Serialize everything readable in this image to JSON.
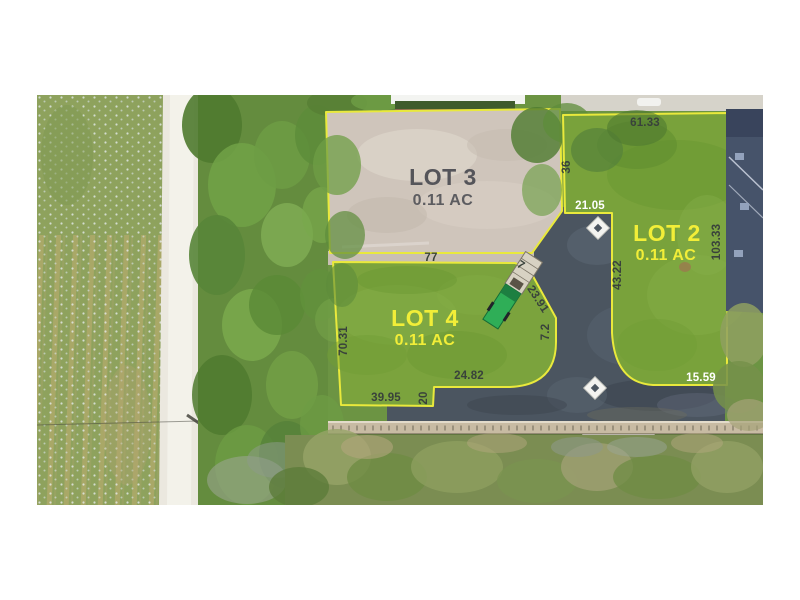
{
  "scene": {
    "type": "aerial-lot-survey-photo"
  },
  "lots": [
    {
      "name": "LOT 3",
      "area": "0.11 AC",
      "surface": "dirt",
      "label_color": "#55555a"
    },
    {
      "name": "LOT 2",
      "area": "0.11 AC",
      "surface": "grass",
      "label_color": "#f2ee38"
    },
    {
      "name": "LOT 4",
      "area": "0.11 AC",
      "surface": "grass",
      "label_color": "#f2ee38"
    }
  ],
  "dimensions": [
    {
      "value": "61.33",
      "lot": "LOT 2",
      "edge": "north",
      "text_color": "dark"
    },
    {
      "value": "36",
      "lot": "LOT 2",
      "edge": "west-upper",
      "text_color": "dark"
    },
    {
      "value": "21.05",
      "lot": "LOT 2",
      "edge": "west-notch",
      "text_color": "white"
    },
    {
      "value": "103.33",
      "lot": "LOT 2",
      "edge": "east",
      "text_color": "dark"
    },
    {
      "value": "43.22",
      "lot": "LOT 2",
      "edge": "west-lower",
      "text_color": "dark"
    },
    {
      "value": "15.59",
      "lot": "LOT 2",
      "edge": "south",
      "text_color": "white"
    },
    {
      "value": "77",
      "lot": "LOT 4",
      "edge": "north",
      "text_color": "dark"
    },
    {
      "value": "7",
      "lot": "LOT 4",
      "edge": "northeast-short",
      "text_color": "dark"
    },
    {
      "value": "23.91",
      "lot": "LOT 4",
      "edge": "northeast-diagonal",
      "text_color": "dark"
    },
    {
      "value": "7.2",
      "lot": "LOT 4",
      "edge": "east",
      "text_color": "dark"
    },
    {
      "value": "70.31",
      "lot": "LOT 4",
      "edge": "west",
      "text_color": "dark"
    },
    {
      "value": "24.82",
      "lot": "LOT 4",
      "edge": "south-notch",
      "text_color": "dark"
    },
    {
      "value": "20",
      "lot": "LOT 4",
      "edge": "southeast-step",
      "text_color": "dark"
    },
    {
      "value": "39.95",
      "lot": "LOT 4",
      "edge": "south",
      "text_color": "dark"
    }
  ],
  "colors": {
    "boundary_line": "#e9e93c",
    "lot_grass": "#79a23b",
    "lot_dirt": "#cfc5bb",
    "asphalt": "#4b5560",
    "gravel_road": "#ebe8df",
    "field": "#8ea25d",
    "house_roof": "#46536a",
    "retaining_wall": "#c8bba3"
  }
}
